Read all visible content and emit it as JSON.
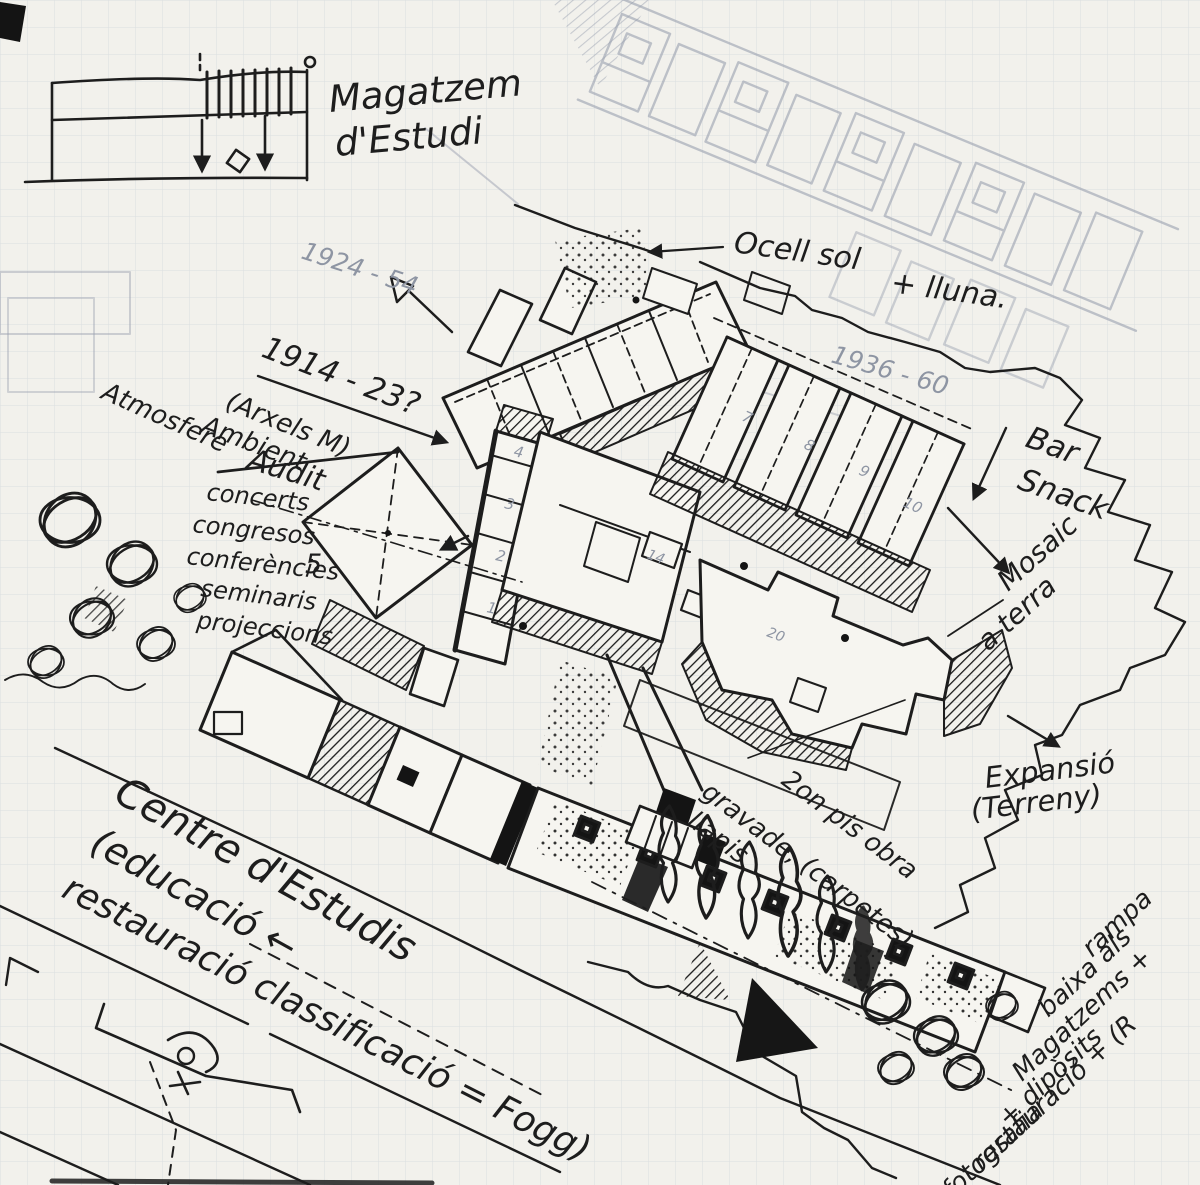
{
  "colors": {
    "paper": "#f2f1ec",
    "grid": "#c8cdd7",
    "ink": "#1d1d1d",
    "pencil": "#8e95a3"
  },
  "annotations": {
    "magatzem_line1": "Magatzem",
    "magatzem_line2": "d'Estudi",
    "date_upper_wing": "1924 - 54",
    "date_phase_1914": "1914 - 23?",
    "arxels": "(Arxels M)",
    "atmosfera_line1": "Atmosfere",
    "atmosfera_line2": "Ambient",
    "audit": "Audit",
    "program": [
      "concerts",
      "congresos",
      "conferències",
      "seminaris",
      "projeccions"
    ],
    "ocell_line1": "Ocell sol",
    "ocell_line2": "+ lluna.",
    "date_phase_1936": "1936 - 60",
    "bar_line1": "Bar",
    "bar_line2": "Snack",
    "mosaic_line1": "Mosaic",
    "mosaic_line2": "a terra",
    "expansio_line1": "Expansió",
    "expansio_line2": "(Terreny)",
    "segon_pis_line1": "2on pis obra",
    "segon_pis_line2": "gravade, (carpetes)",
    "segon_pis_line3": "llapis",
    "centre_line1": "Centre d'Estudis",
    "centre_line2": "(educació ←",
    "centre_line3": "restauració classificació = Fogg)",
    "rampa_lines": [
      "rampa",
      "baixa als",
      "Magatzems +",
      "+ dipòsits",
      "restauració + (R",
      "fotografia"
    ]
  },
  "plan_numbers": {
    "left_wing": [
      "1",
      "2",
      "3",
      "4"
    ],
    "right_wing": [
      "7",
      "8",
      "9",
      "10"
    ],
    "courtyard": [
      "14",
      "20"
    ],
    "auditorium": "5"
  }
}
